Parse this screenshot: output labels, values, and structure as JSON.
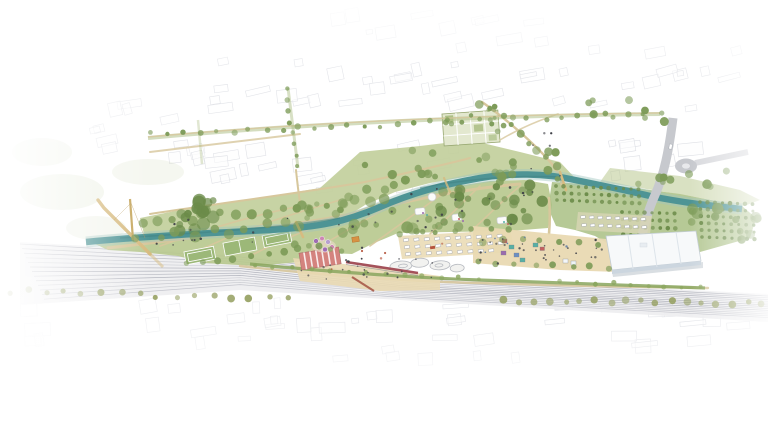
{
  "scene": {
    "type": "architectural-masterplan-aerial-rendering",
    "features": [
      "river",
      "riverside-park",
      "railway-corridor",
      "cable-stayed-footbridge",
      "tree-lined-avenue",
      "allotment-gardens",
      "sports-courts",
      "market-hall",
      "station-platforms",
      "platform-canopy",
      "skatepark",
      "parking-lots",
      "event-hall",
      "orchard-plots",
      "road-bridge-roundabout",
      "central-plaza",
      "kiosks",
      "playground-pavilions",
      "umbrella-terrace",
      "sketched-city-context"
    ]
  },
  "colors": {
    "background": "#ffffff",
    "sketch_line": "#c7cad3",
    "sketch_fill": "#fbfbfc",
    "river": "#4e9495",
    "river_bank": "#9fc5bf",
    "park": "#c1ce9a",
    "meadow": "#b9c98f",
    "orchard_base": "#a9bf84",
    "court_green": "#9cb878",
    "tree": "#7d9b58",
    "tree_dark": "#6b8b49",
    "tree_olive": "#97a163",
    "hedge": "#8aa65e",
    "path": "#d7c79c",
    "avenue_green": "#a9bb7f",
    "plaza": "#e9d9b2",
    "rail_bed": "#ededf0",
    "rail_line": "#b2b4bd",
    "road": "#c7c9ce",
    "hall_roof": "#f7f9fa",
    "hall_side": "#ccd6df",
    "hall_edge": "#c2ccd4",
    "market_red": "#d4837e",
    "canopy_red": "#a4525b",
    "ramp_red": "#a75a49",
    "bridge_tan": "#d7bb80",
    "pylon_tan": "#c6a75e",
    "umbrella_purple": "#a06cb4",
    "umbrella_pink": "#cd86b4",
    "umbrella_lavender": "#b79fd0",
    "kiosk_teal": "#57b0a4",
    "kiosk_red": "#c4605f",
    "kiosk_purple": "#9a6bae",
    "kiosk_blue": "#6b8fc2",
    "pavilion_orange": "#d79243",
    "skate_concrete": "#f2f2f0",
    "skate_outline": "#b7bac0",
    "car": "#ffffff",
    "car_line": "#9fa3ab",
    "people": "#3f4148",
    "terrace_sand": "#e6d9c4",
    "platform_gray": "#dddde2"
  }
}
